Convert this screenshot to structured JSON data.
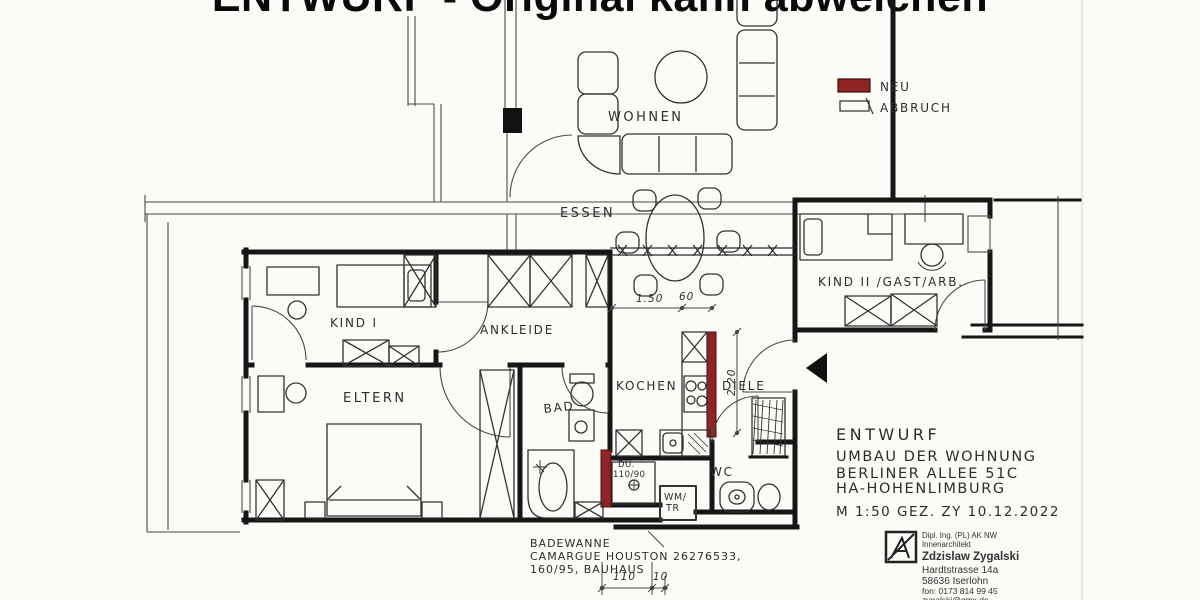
{
  "title": "ENTWURF - Original kann abweichen",
  "legend": {
    "neu_label": "NEU",
    "abbruch_label": "ABBRUCH",
    "neu_color": "#8e2424"
  },
  "rooms": {
    "wohnen": "WOHNEN",
    "essen": "ESSEN",
    "kind1": "KIND I",
    "ankleide": "ANKLEIDE",
    "eltern": "ELTERN",
    "bad": "BAD",
    "kochen": "KOCHEN",
    "diele": "DIELE",
    "wc": "WC",
    "kind2": "KIND II /GAST/ARB."
  },
  "fixtures": {
    "shower_line1": "DU.",
    "shower_line2": "110/90",
    "washer_line1": "WM/",
    "washer_line2": "TR"
  },
  "dimensions": {
    "kitchen_width": "1.50",
    "counter_depth": "60",
    "hall_length": "2.20",
    "bottom_a": "110",
    "bottom_b": "10"
  },
  "notes": {
    "line1": "BADEWANNE",
    "line2": "CAMARGUE HOUSTON 26276533,",
    "line3": "160/95, BAUHAUS"
  },
  "project": {
    "line1": "ENTWURF",
    "line2": "UMBAU DER WOHNUNG",
    "line3": "BERLINER ALLEE 51C",
    "line4": "HA-HOHENLIMBURG",
    "line5": "M 1:50   GEZ. ZY    10.12.2022"
  },
  "stamp": {
    "line1": "Dipl. Ing. (PL) AK NW",
    "line2": "Innenarchitekt",
    "name": "Zdzislaw Zygalski",
    "line3": "Hardtstrasse 14a",
    "line4": "58636 Iserlohn",
    "line5": "fon: 0173 814 99 45",
    "line6": "zygalski@gmx.de"
  }
}
